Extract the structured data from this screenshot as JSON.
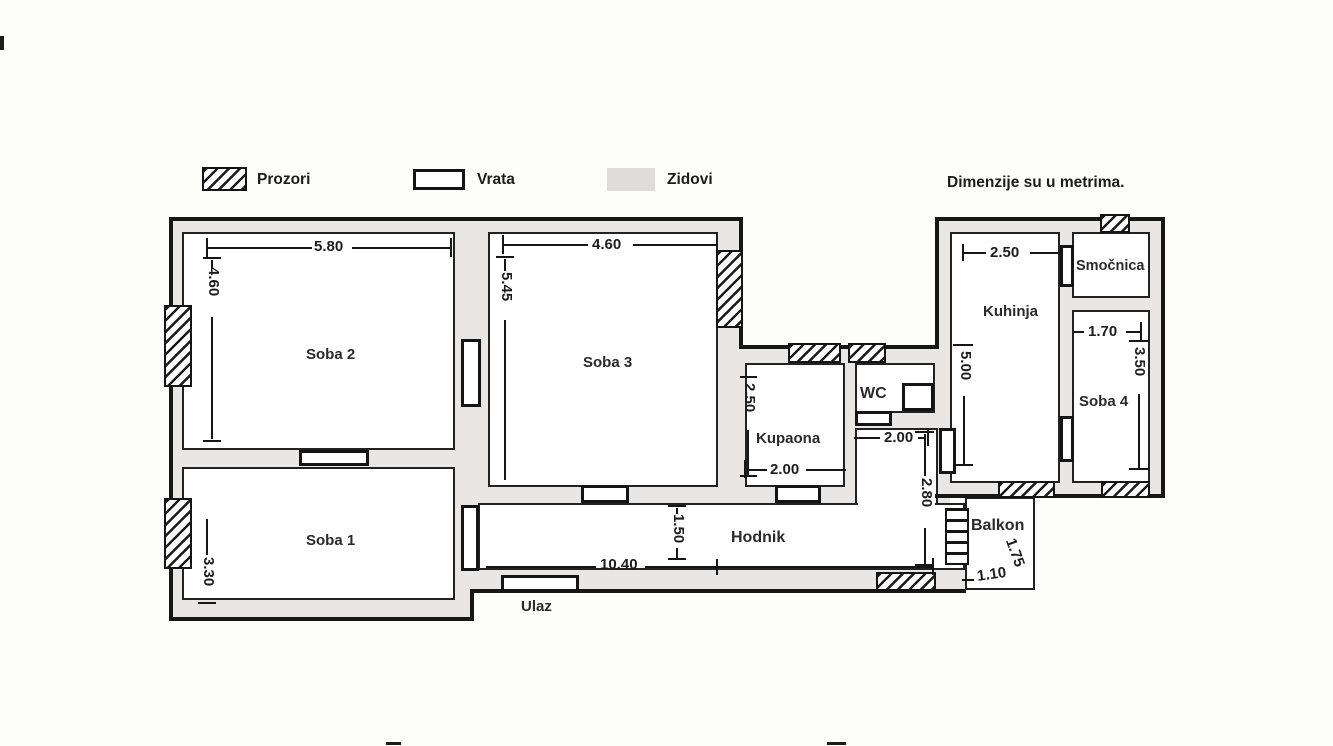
{
  "legend": {
    "window_label": "Prozori",
    "door_label": "Vrata",
    "wall_label": "Zidovi",
    "note": "Dimenzije su u metrima."
  },
  "rooms": {
    "soba2": {
      "name": "Soba 2",
      "width_m": "5.80",
      "height_m": "4.60"
    },
    "soba3": {
      "name": "Soba 3",
      "width_m": "4.60",
      "height_m": "5.45"
    },
    "soba1": {
      "name": "Soba 1",
      "height_m": "3.30"
    },
    "kupaona": {
      "name": "Kupaona",
      "height_m": "2.50",
      "width_m": "2.00"
    },
    "wc": {
      "name": "WC",
      "width_m": "2.00"
    },
    "hodnik": {
      "name": "Hodnik",
      "length_m": "10.40",
      "width_m": "1.50",
      "side_m": "2.80"
    },
    "kuhinja": {
      "name": "Kuhinja",
      "width_m": "2.50",
      "height_m": "5.00"
    },
    "smocnica": {
      "name": "Smočnica"
    },
    "soba4": {
      "name": "Soba 4",
      "width_m": "1.70",
      "height_m": "3.50"
    },
    "balkon": {
      "name": "Balkon",
      "height_m": "1.75",
      "width_m": "1.10"
    },
    "ulaz": {
      "name": "Ulaz"
    }
  },
  "colors": {
    "wall_fill": "#e9e6e6",
    "line": "#161616",
    "paper": "#fdfdfc"
  }
}
